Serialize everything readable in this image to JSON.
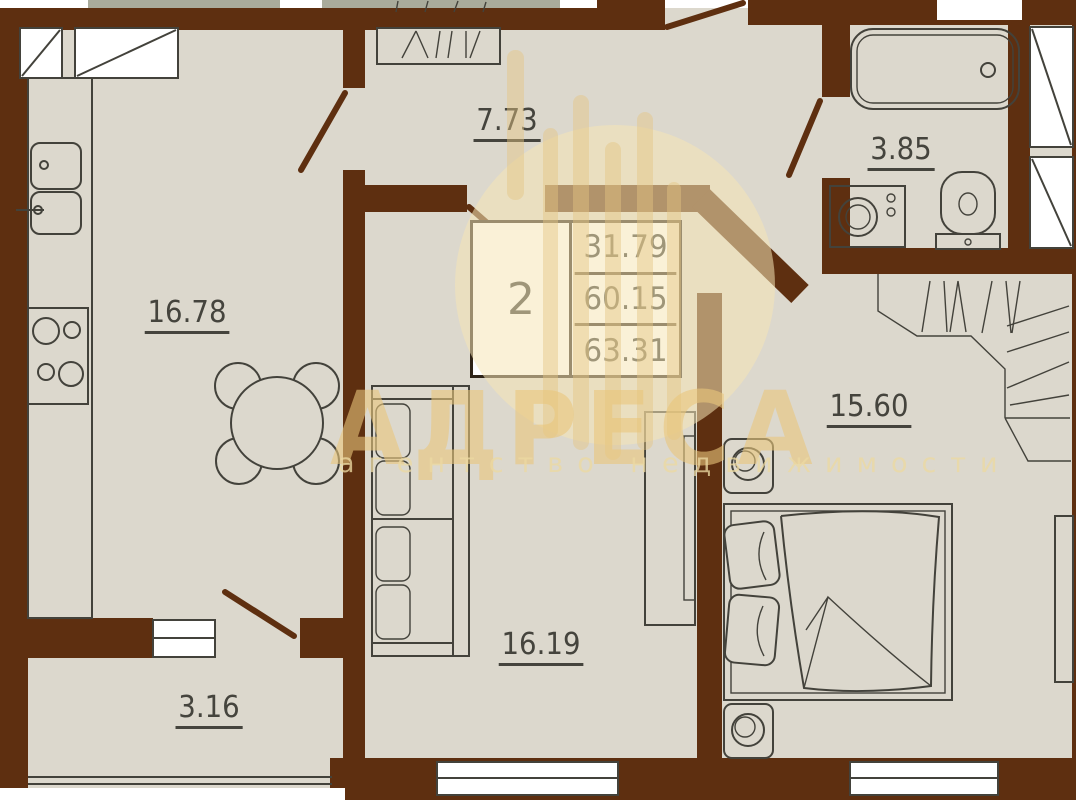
{
  "watermark": {
    "title": "АДРЕСА",
    "subtitle": "агентство недвижимости"
  },
  "info_box": {
    "rooms_count": "2",
    "values": [
      "31.79",
      "60.15",
      "63.31"
    ]
  },
  "rooms": {
    "kitchen": {
      "name": "kitchen",
      "label": "16.78"
    },
    "hallway": {
      "name": "hallway",
      "label": "7.73"
    },
    "bathroom": {
      "name": "bathroom",
      "label": "3.85"
    },
    "bedroom": {
      "name": "bedroom",
      "label": "15.60"
    },
    "living_room": {
      "name": "living-room",
      "label": "16.19"
    },
    "balcony": {
      "name": "balcony",
      "label": "3.16"
    }
  },
  "colors": {
    "wall": "#5e2f10",
    "floor": "#dcd8cd",
    "line": "#43423b",
    "green": "#a9ab9b",
    "accent": "#e9c87f"
  }
}
